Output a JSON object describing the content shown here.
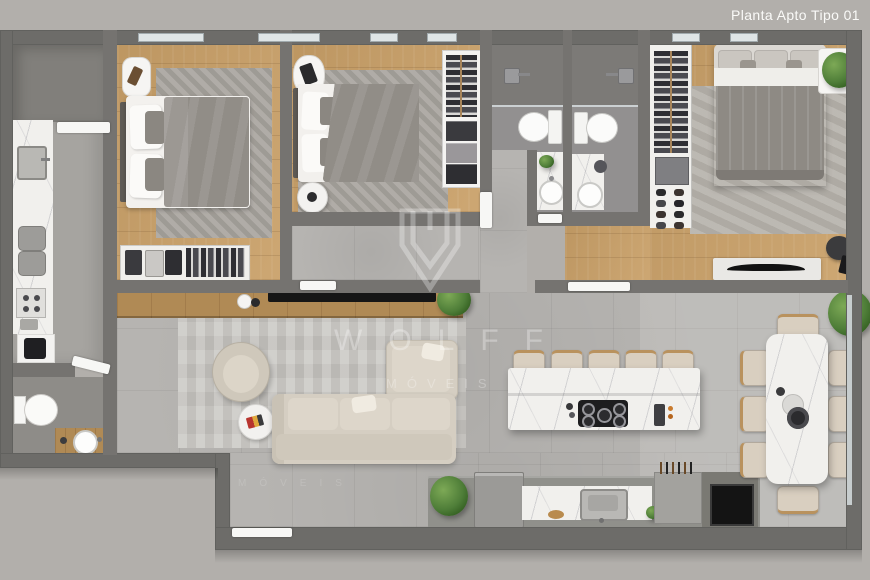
{
  "header": {
    "title": "Planta Apto Tipo 01"
  },
  "watermark": {
    "brand": "WOLFF",
    "subtitle": "MÓVEIS",
    "echo": "MÓVEIS"
  },
  "colors": {
    "backdrop": "#b2afab",
    "wall": "#6d6c69",
    "wall-inner": "#757370",
    "wood": "#c9a068",
    "wood-dark": "#b08a55",
    "tile": "#b6b4b1",
    "bath-floor": "#929090",
    "shower-floor": "#7c7a77",
    "service-floor": "#817f7b",
    "lavabo-floor": "#8e8c88",
    "kitchen-floor": "#a6a4a0",
    "marble": "#f1f0ed",
    "rug": "#a7a39d",
    "rug-suite": "#b5b1aa",
    "rug-living": "#c7c5c1",
    "sofa": "#d5cec2",
    "sofa-cushion": "#ddd6ca",
    "duvet": "#918d87",
    "stool": "#d9cfc0",
    "stool-wood": "#b9925e",
    "dark-item": "#1d1d1f",
    "plant": "#4e7d38",
    "door": "#f7f7f5",
    "window": "#dfe5e6",
    "title-text": "#fafaf8"
  }
}
